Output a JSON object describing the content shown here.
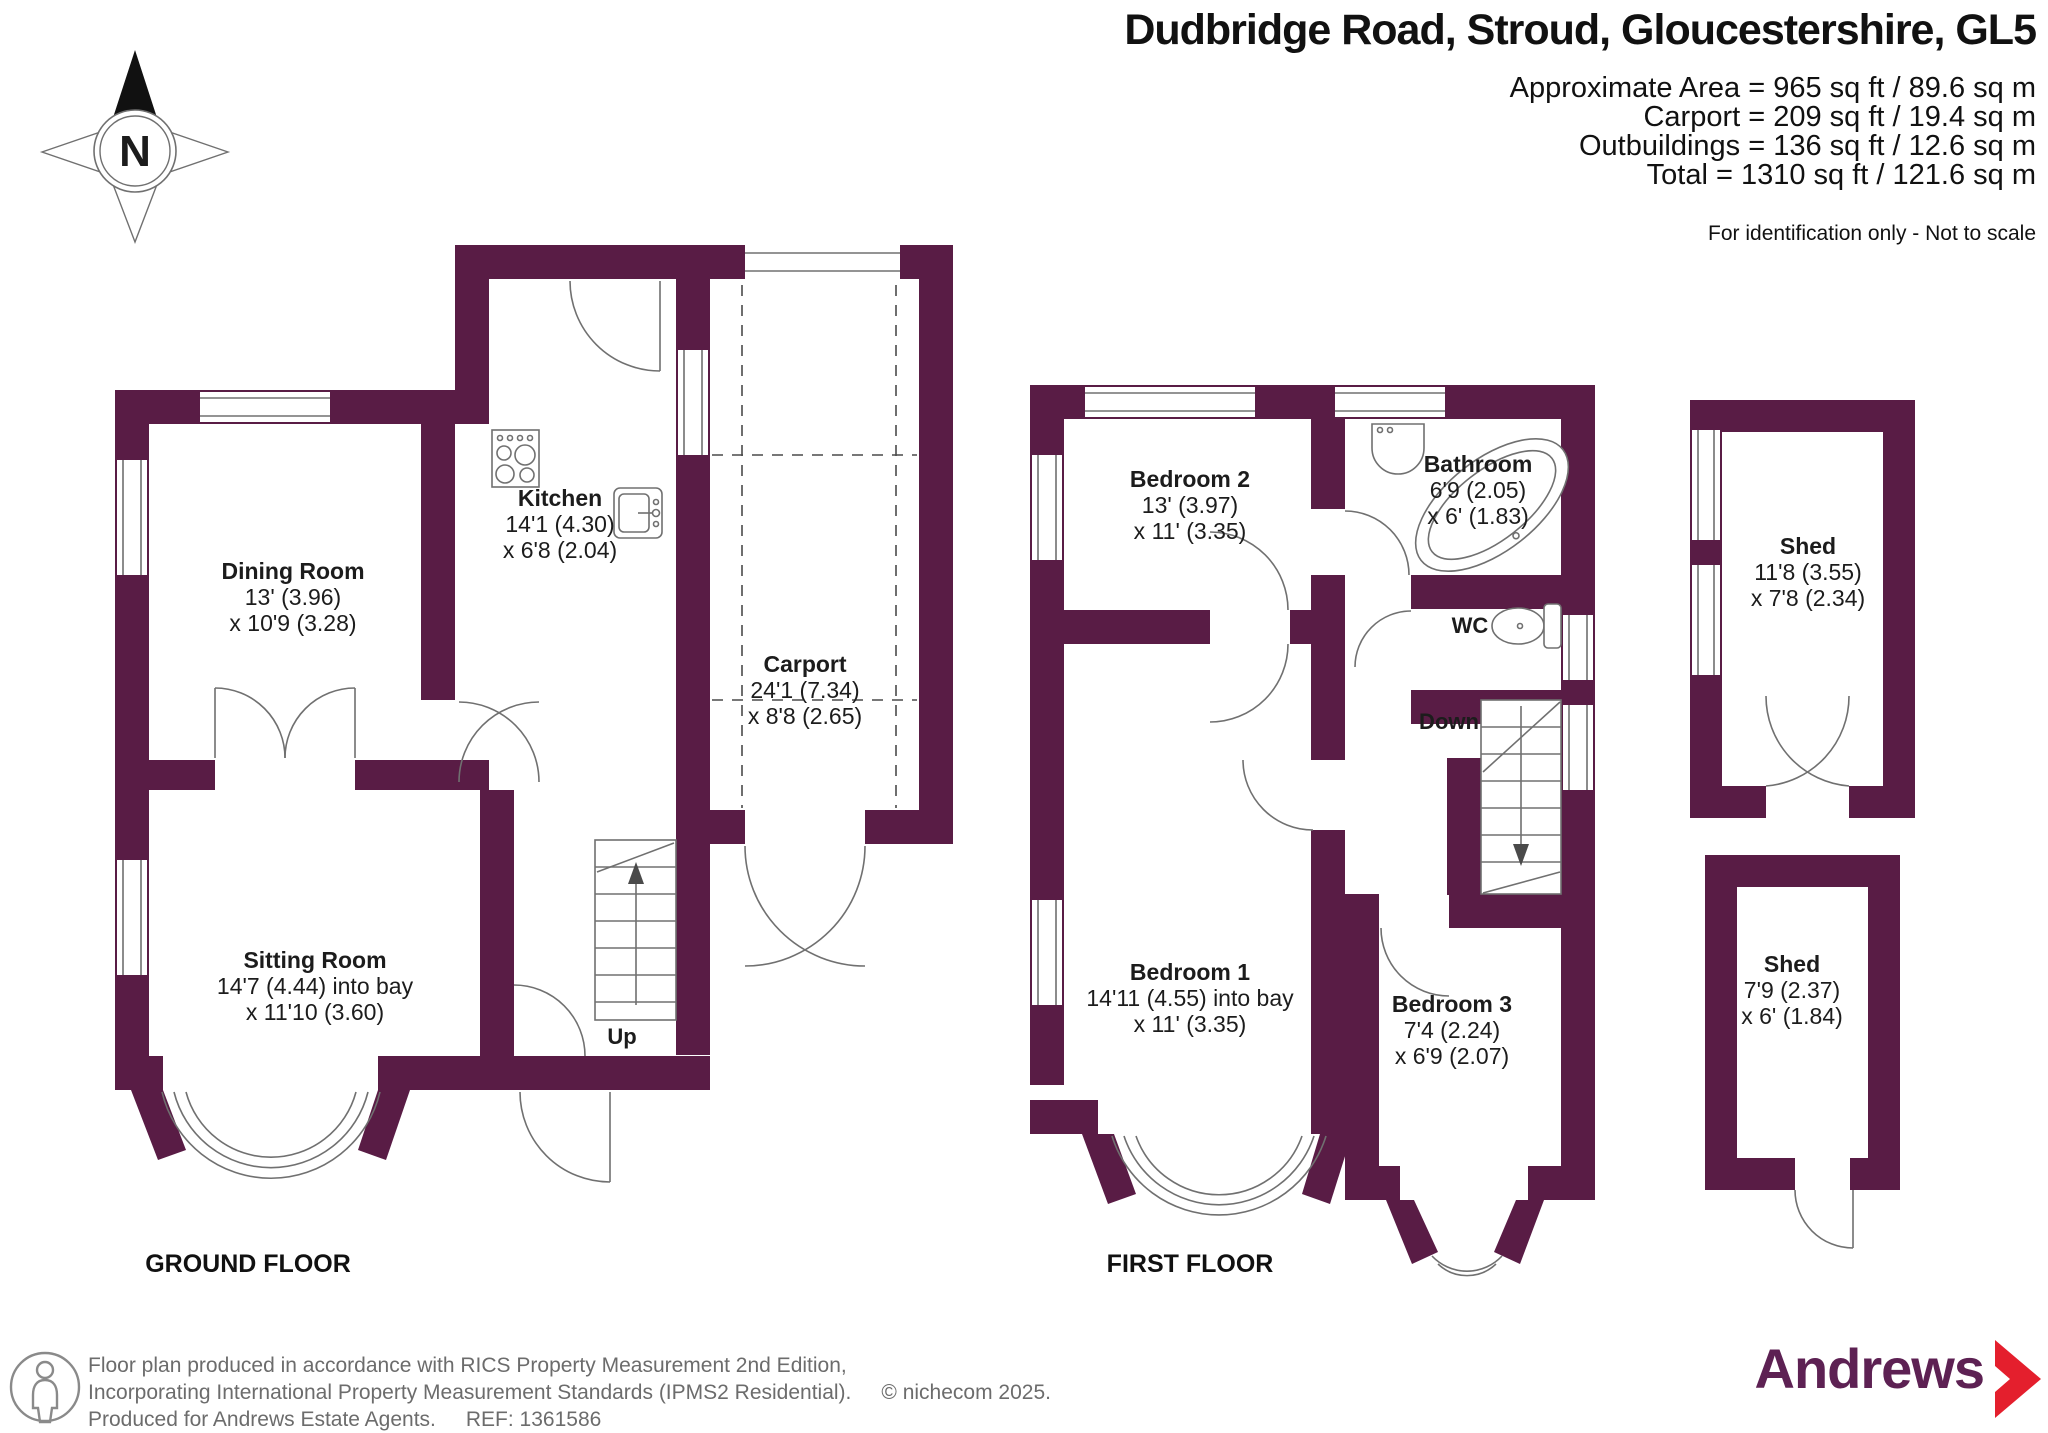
{
  "header": {
    "title": "Dudbridge Road, Stroud, Gloucestershire, GL5",
    "area_lines": [
      "Approximate Area = 965 sq ft / 89.6 sq m",
      "Carport = 209 sq ft / 19.4 sq m",
      "Outbuildings = 136 sq ft / 12.6 sq m",
      "Total = 1310 sq ft / 121.6 sq m"
    ],
    "disclaimer": "For identification only - Not to scale"
  },
  "compass": {
    "label": "N"
  },
  "ground_floor": {
    "label": "GROUND FLOOR",
    "stairs_label": "Up",
    "rooms": {
      "dining": {
        "name": "Dining Room",
        "line1": "13' (3.96)",
        "line2": "x 10'9 (3.28)"
      },
      "kitchen": {
        "name": "Kitchen",
        "line1": "14'1 (4.30)",
        "line2": "x 6'8 (2.04)"
      },
      "sitting": {
        "name": "Sitting Room",
        "line1": "14'7 (4.44) into bay",
        "line2": "x 11'10 (3.60)"
      },
      "carport": {
        "name": "Carport",
        "line1": "24'1 (7.34)",
        "line2": "x 8'8 (2.65)"
      }
    }
  },
  "first_floor": {
    "label": "FIRST FLOOR",
    "stairs_label": "Down",
    "wc_label": "WC",
    "rooms": {
      "bedroom2": {
        "name": "Bedroom 2",
        "line1": "13' (3.97)",
        "line2": "x 11' (3.35)"
      },
      "bathroom": {
        "name": "Bathroom",
        "line1": "6'9 (2.05)",
        "line2": "x 6' (1.83)"
      },
      "bedroom1": {
        "name": "Bedroom 1",
        "line1": "14'11 (4.55) into bay",
        "line2": "x 11' (3.35)"
      },
      "bedroom3": {
        "name": "Bedroom 3",
        "line1": "7'4 (2.24)",
        "line2": "x 6'9 (2.07)"
      }
    }
  },
  "outbuildings": {
    "shed1": {
      "name": "Shed",
      "line1": "11'8 (3.55)",
      "line2": "x 7'8 (2.34)"
    },
    "shed2": {
      "name": "Shed",
      "line1": "7'9 (2.37)",
      "line2": "x 6' (1.84)"
    }
  },
  "footer": {
    "line1": "Floor plan produced in accordance with RICS Property Measurement 2nd Edition,",
    "line2": "Incorporating International Property Measurement Standards (IPMS2 Residential).",
    "copyright": "© nichecom 2025.",
    "line3": "Produced for Andrews Estate Agents.",
    "ref": "REF: 1361586",
    "brand": "Andrews"
  },
  "colors": {
    "wall": "#591c45",
    "thin_line": "#707070",
    "brand_purple": "#5d2153",
    "brand_red": "#e41f2d"
  }
}
